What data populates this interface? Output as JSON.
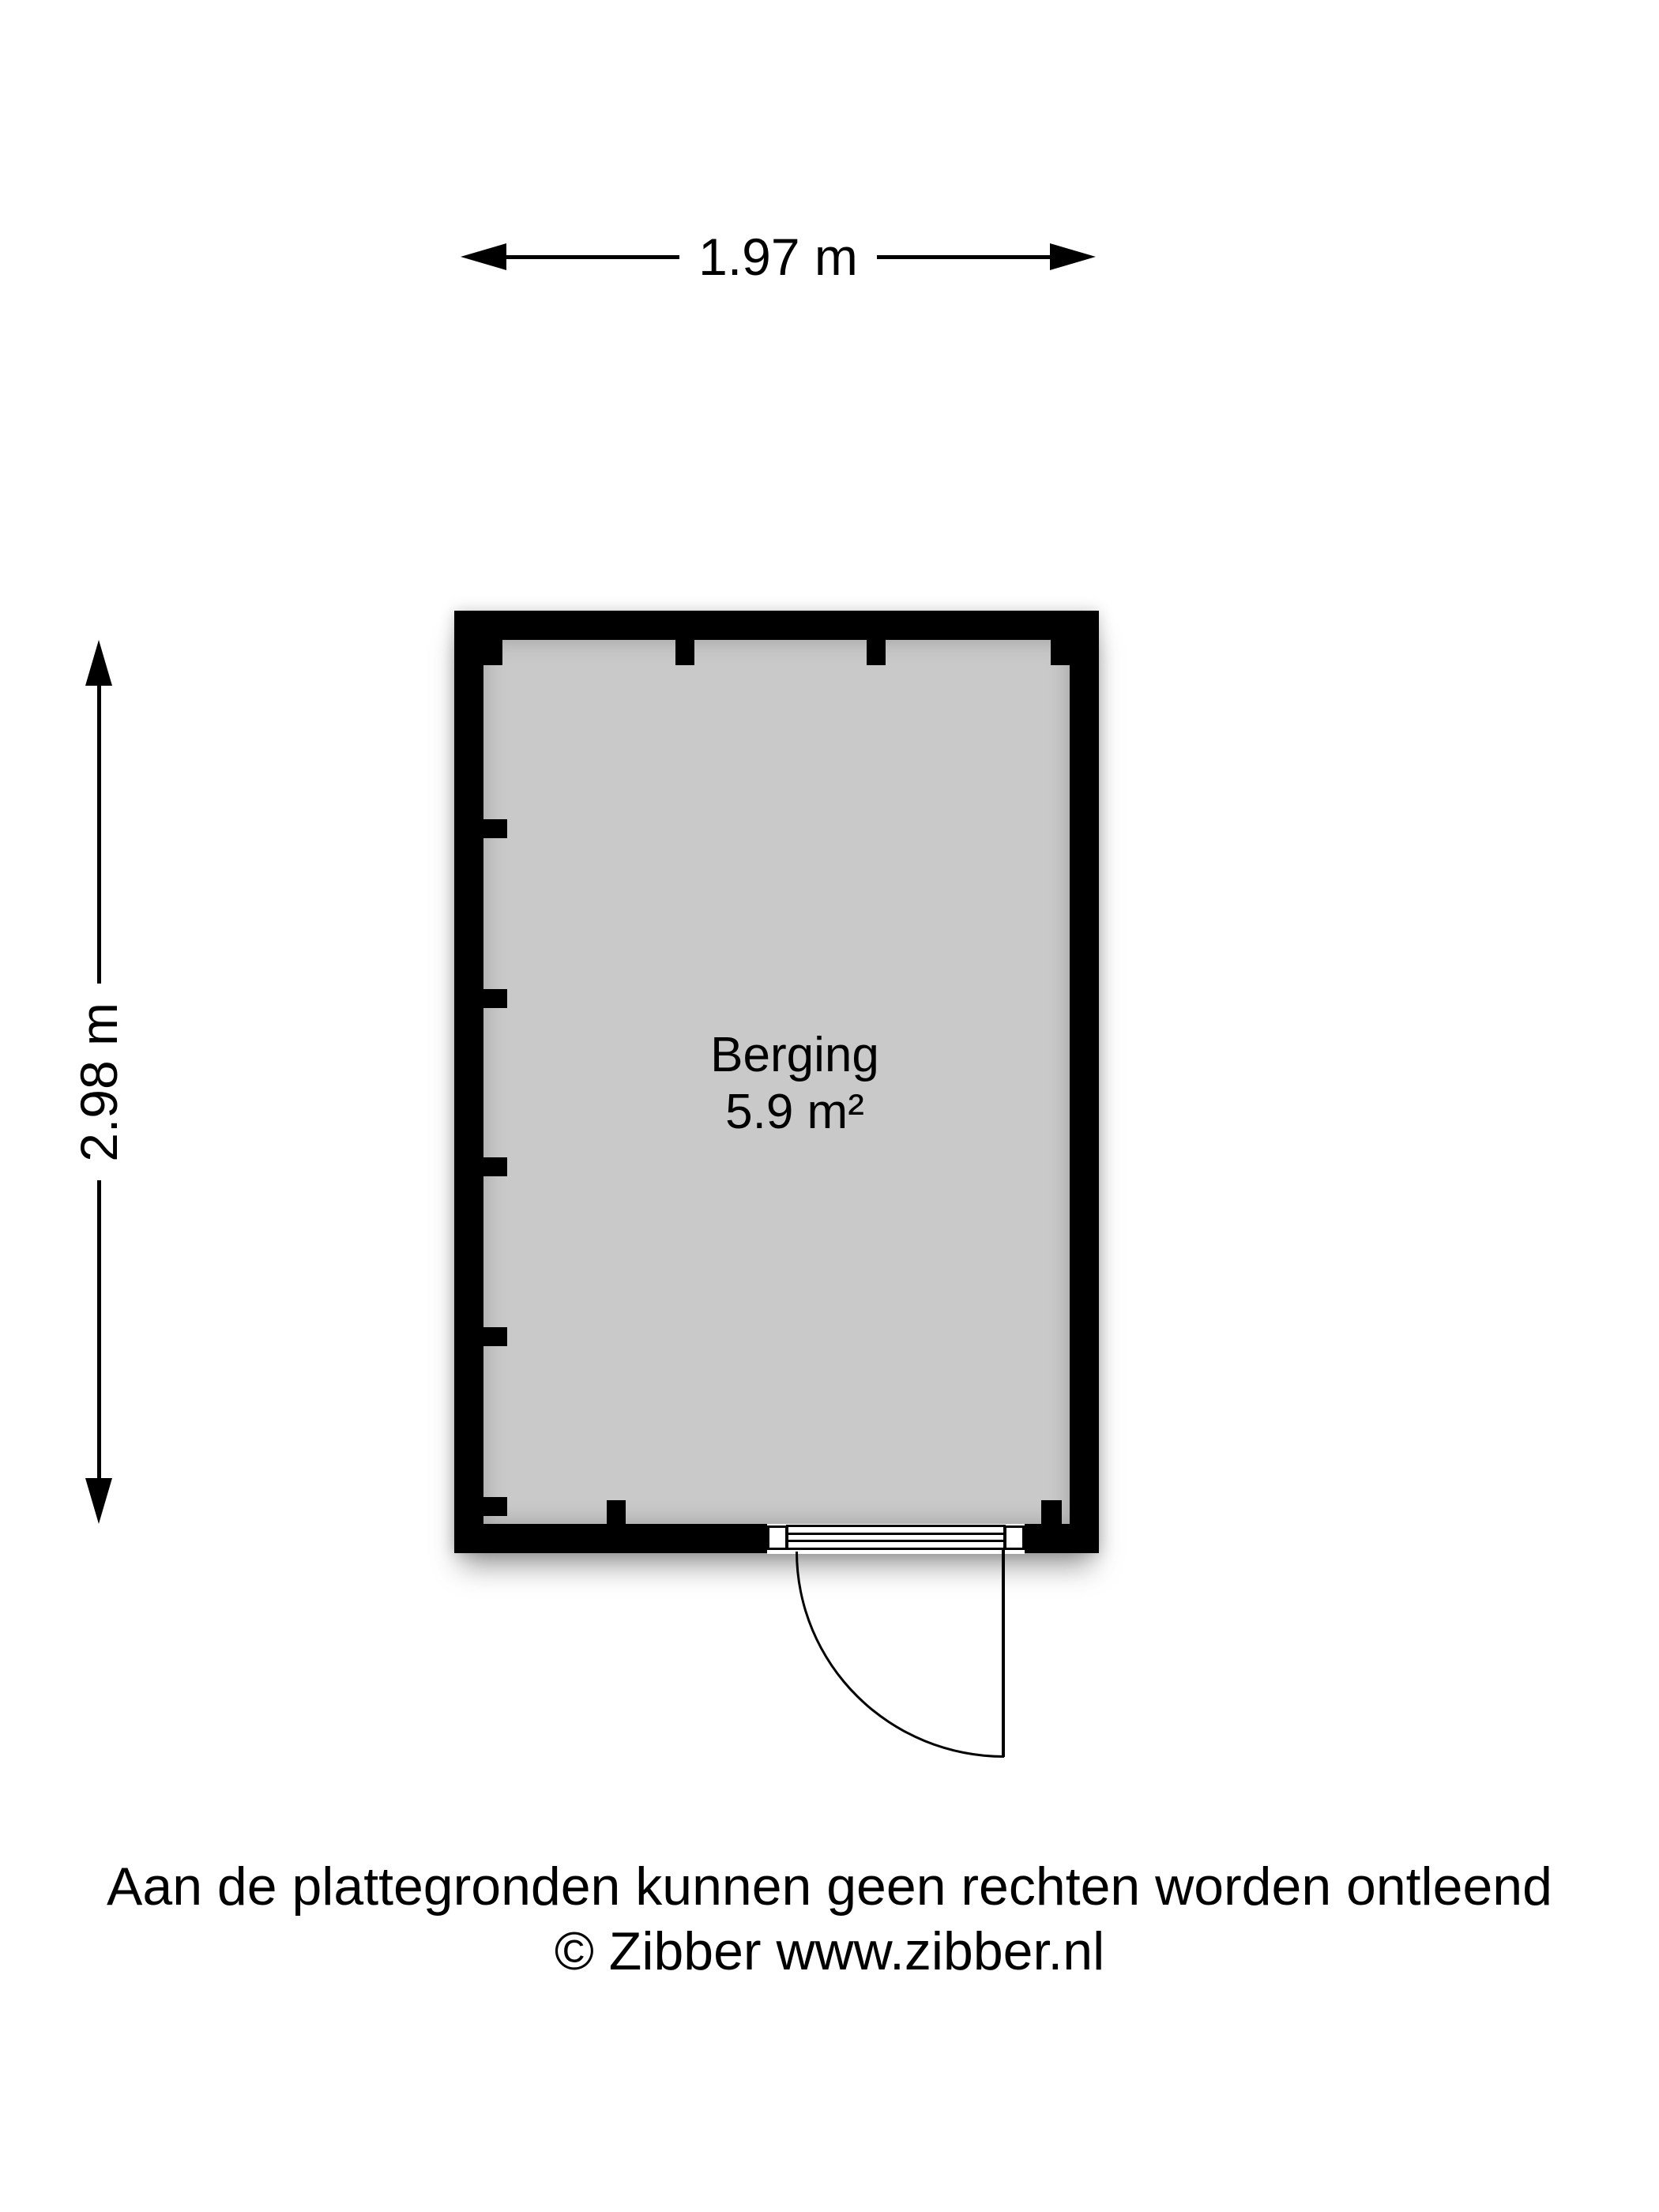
{
  "dimensions": {
    "width": "1.97 m",
    "height": "2.98 m"
  },
  "room": {
    "name": "Berging",
    "area": "5.9 m²"
  },
  "footer": {
    "disclaimer": "Aan de plattegronden kunnen geen rechten worden ontleend",
    "copyright": "© Zibber www.zibber.nl"
  },
  "colors": {
    "wall": "#000000",
    "floor": "#c9c9c9",
    "background": "#ffffff",
    "text": "#000000"
  }
}
